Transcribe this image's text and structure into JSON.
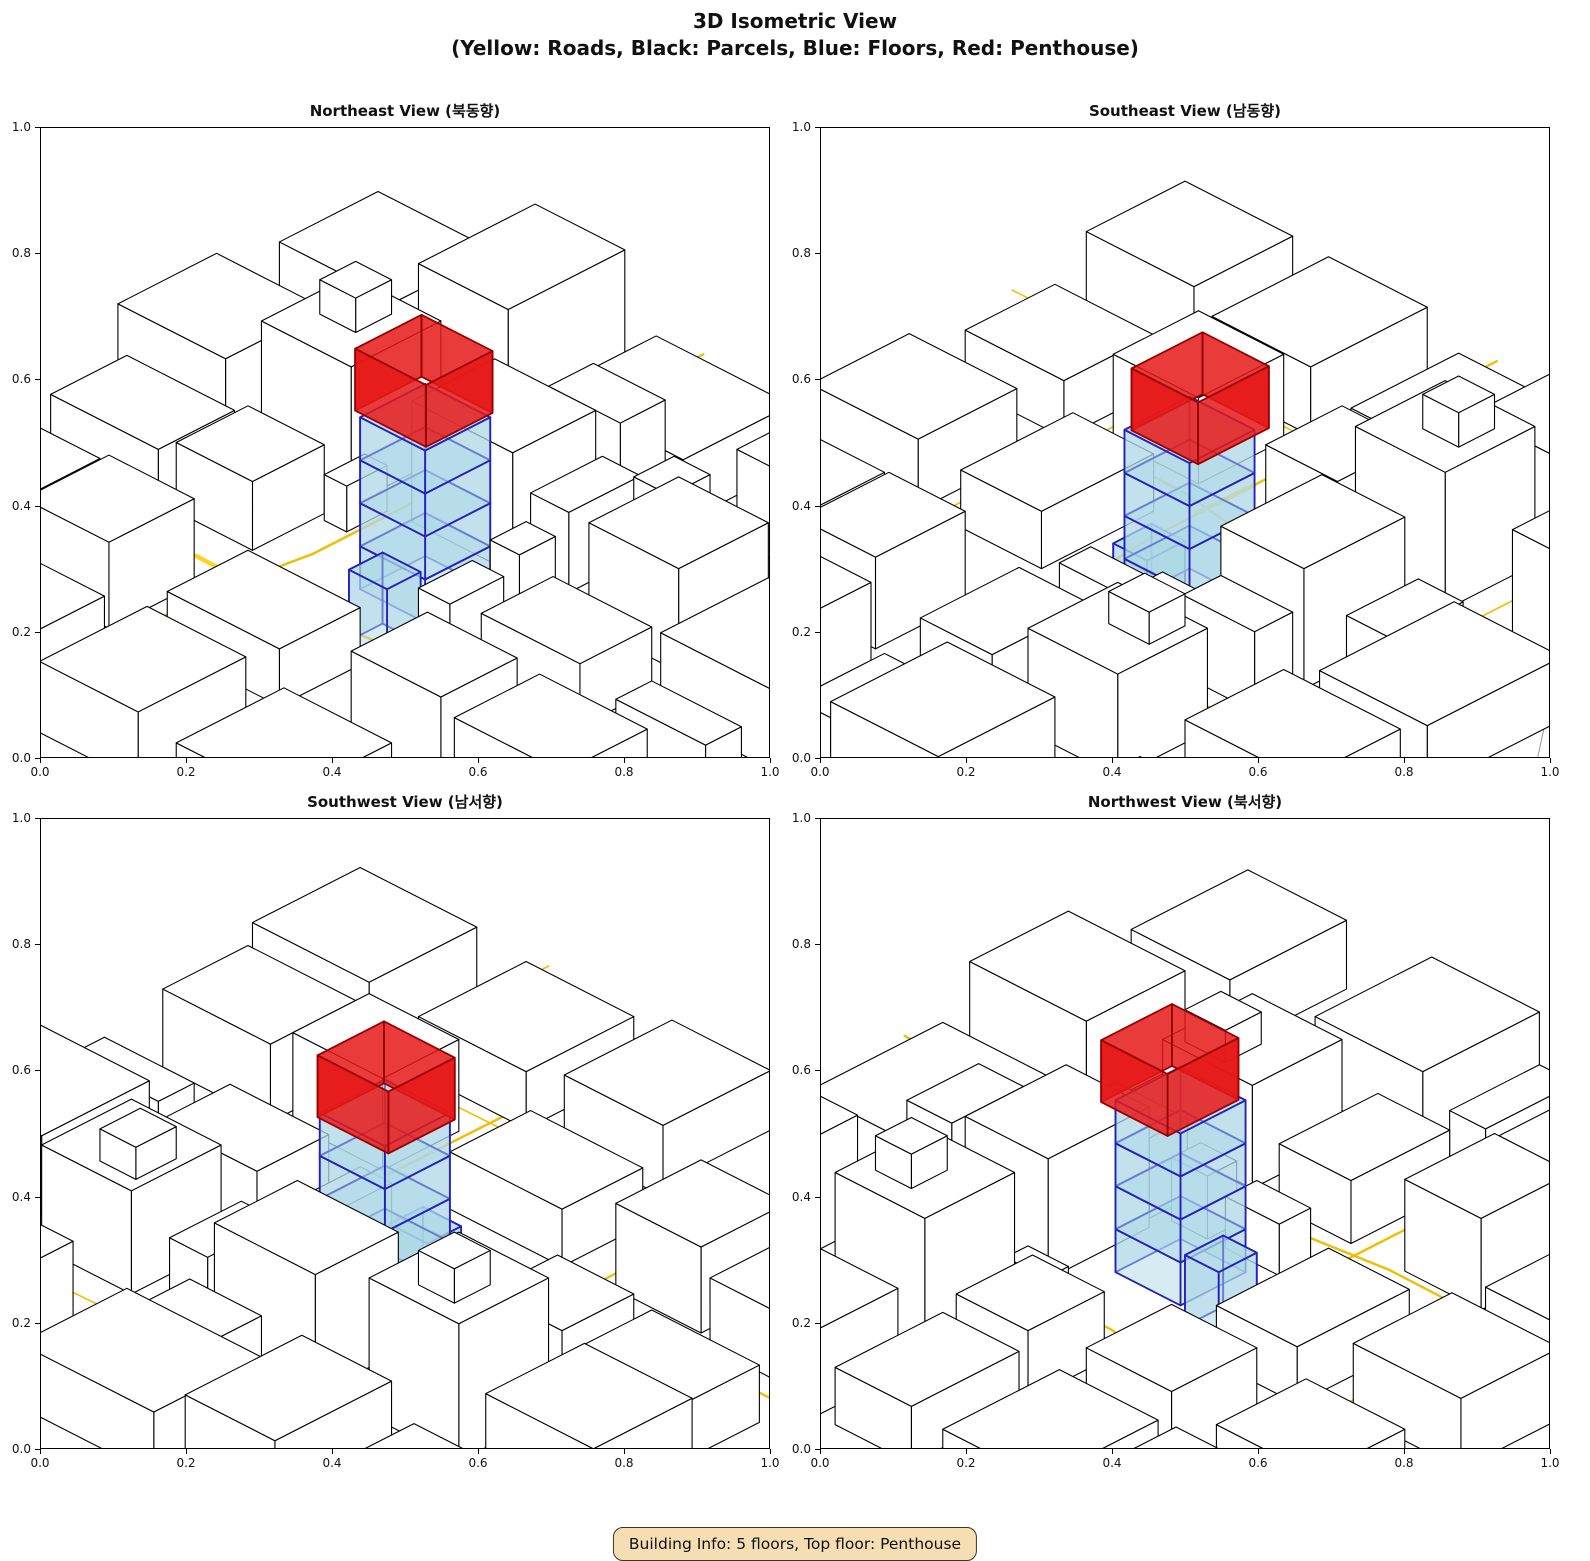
{
  "figure": {
    "title_line1": "3D Isometric View",
    "title_line2": "(Yellow: Roads, Black: Parcels, Blue: Floors, Red: Penthouse)",
    "info_text": "Building Info: 5 floors, Top floor: Penthouse"
  },
  "building_info": {
    "floors": 5,
    "top_floor": "Penthouse"
  },
  "axes": {
    "ticks": [
      "0.0",
      "0.2",
      "0.4",
      "0.6",
      "0.8",
      "1.0"
    ]
  },
  "subplots": [
    {
      "id": "ne",
      "title": "Northeast View (북동향)",
      "rotation": 0
    },
    {
      "id": "se",
      "title": "Southeast View (남동향)",
      "rotation": 1
    },
    {
      "id": "sw",
      "title": "Southwest View (남서향)",
      "rotation": 2
    },
    {
      "id": "nw",
      "title": "Northwest View (북서향)",
      "rotation": 3
    }
  ],
  "colors": {
    "road": "#F2BC00",
    "road_highlight": "#FFD21F",
    "parcel_fill": "#FFFFFF",
    "parcel_edge": "#000000",
    "floor_fill": "rgba(173,216,230,0.5)",
    "floor_edge": "#2222BB",
    "penthouse_fill": "rgba(230,25,25,0.85)",
    "penthouse_edge": "#990000",
    "contour": "#999999",
    "info_bg": "#F5DEB3"
  },
  "render": {
    "sx": 450,
    "sy": 230,
    "sz": 1150,
    "cx": 365,
    "cy": 465
  },
  "scene": {
    "contours": [
      [
        [
          -0.3,
          0.42
        ],
        [
          -0.05,
          0.22
        ],
        [
          0.3,
          -0.12
        ],
        [
          0.55,
          -0.32
        ]
      ],
      [
        [
          0.62,
          1.35
        ],
        [
          0.95,
          1.02
        ],
        [
          1.32,
          0.86
        ]
      ]
    ],
    "roads": [
      {
        "pts": [
          [
            0.315,
            -0.35
          ],
          [
            0.315,
            0.52
          ],
          [
            0.285,
            0.72
          ],
          [
            0.285,
            1.35
          ]
        ],
        "lw": 2.4,
        "hl": false
      },
      {
        "pts": [
          [
            -0.35,
            0.655
          ],
          [
            0.42,
            0.655
          ],
          [
            0.7,
            0.63
          ],
          [
            1.35,
            0.63
          ]
        ],
        "lw": 2.4,
        "hl": false
      },
      {
        "pts": [
          [
            0.725,
            -0.35
          ],
          [
            0.725,
            0.44
          ],
          [
            0.755,
            0.7
          ],
          [
            0.75,
            1.35
          ]
        ],
        "lw": 2.4,
        "hl": false
      },
      {
        "pts": [
          [
            -0.35,
            0.115
          ],
          [
            0.6,
            0.115
          ],
          [
            1.35,
            0.095
          ]
        ],
        "lw": 1.6,
        "hl": false
      },
      {
        "pts": [
          [
            -0.35,
            0.93
          ],
          [
            0.55,
            0.945
          ],
          [
            1.35,
            0.935
          ]
        ],
        "lw": 1.6,
        "hl": false
      },
      {
        "pts": [
          [
            0.02,
            -0.35
          ],
          [
            0.035,
            1.35
          ]
        ],
        "lw": 1.6,
        "hl": false
      },
      {
        "pts": [
          [
            1.04,
            -0.35
          ],
          [
            1.03,
            1.35
          ]
        ],
        "lw": 1.6,
        "hl": false
      },
      {
        "pts": [
          [
            0.19,
            0.655
          ],
          [
            0.315,
            0.658
          ]
        ],
        "lw": 4.5,
        "hl": true
      }
    ],
    "parcels": [
      [
        -0.24,
        -0.18,
        0.26,
        0.22,
        0.065
      ],
      [
        0.05,
        -0.24,
        0.2,
        0.26,
        0.1
      ],
      [
        0.36,
        -0.2,
        0.3,
        0.24,
        0.055
      ],
      [
        0.4,
        -0.02,
        0.16,
        0.1,
        0.075
      ],
      [
        0.76,
        -0.24,
        0.22,
        0.26,
        0.08
      ],
      [
        1.06,
        -0.18,
        0.26,
        0.22,
        0.06
      ],
      [
        -0.26,
        0.16,
        0.24,
        0.22,
        0.075
      ],
      [
        -0.2,
        0.42,
        0.24,
        0.17,
        0.05
      ],
      [
        0.05,
        0.17,
        0.2,
        0.2,
        0.12
      ],
      [
        0.07,
        0.42,
        0.17,
        0.16,
        0.06
      ],
      [
        0.355,
        0.155,
        0.225,
        0.185,
        0.105
      ],
      [
        0.6,
        0.16,
        0.085,
        0.16,
        0.07
      ],
      [
        0.62,
        0.47,
        0.07,
        0.12,
        0.045
      ],
      [
        0.78,
        0.17,
        0.2,
        0.2,
        0.09
      ],
      [
        0.77,
        0.44,
        0.22,
        0.16,
        0.055
      ],
      [
        1.05,
        0.24,
        0.26,
        0.24,
        0.07
      ],
      [
        1.07,
        0.52,
        0.2,
        0.08,
        0.04
      ],
      [
        -0.24,
        0.7,
        0.26,
        0.22,
        0.06
      ],
      [
        0.06,
        0.72,
        0.19,
        0.19,
        0.075
      ],
      [
        0.36,
        0.71,
        0.25,
        0.18,
        0.05
      ],
      [
        0.1,
        0.97,
        0.2,
        0.22,
        0.05
      ],
      [
        -0.22,
        0.98,
        0.22,
        0.24,
        0.07
      ],
      [
        0.4,
        0.975,
        0.22,
        0.24,
        0.062
      ],
      [
        0.77,
        0.72,
        0.2,
        0.17,
        0.08
      ],
      [
        0.7,
        0.97,
        0.24,
        0.24,
        0.05
      ],
      [
        1.0,
        0.7,
        0.24,
        0.19,
        0.068
      ],
      [
        1.05,
        0.97,
        0.26,
        0.24,
        0.058
      ],
      [
        0.255,
        0.345,
        0.05,
        0.09,
        0.04
      ],
      [
        0.62,
        0.35,
        0.065,
        0.08,
        0.055
      ],
      [
        0.1,
        0.21,
        0.08,
        0.08,
        0.03,
        0.12
      ],
      [
        0.8,
        0.2,
        0.08,
        0.09,
        0.028,
        0.09
      ]
    ],
    "target": {
      "floors": [
        {
          "x": 0.445,
          "y": 0.4,
          "w": 0.145,
          "d": 0.145,
          "z0": 0.0,
          "h": 0.0375
        },
        {
          "x": 0.445,
          "y": 0.4,
          "w": 0.145,
          "d": 0.145,
          "z0": 0.0375,
          "h": 0.0375
        },
        {
          "x": 0.445,
          "y": 0.4,
          "w": 0.145,
          "d": 0.145,
          "z0": 0.075,
          "h": 0.0375
        },
        {
          "x": 0.445,
          "y": 0.4,
          "w": 0.145,
          "d": 0.145,
          "z0": 0.1125,
          "h": 0.0375
        }
      ],
      "annex": {
        "x": 0.475,
        "y": 0.525,
        "w": 0.085,
        "d": 0.075,
        "z0": -0.028,
        "h": 0.062
      },
      "penthouse": {
        "x": 0.425,
        "y": 0.388,
        "w": 0.158,
        "d": 0.148,
        "z0": 0.15,
        "h": 0.054
      }
    }
  }
}
